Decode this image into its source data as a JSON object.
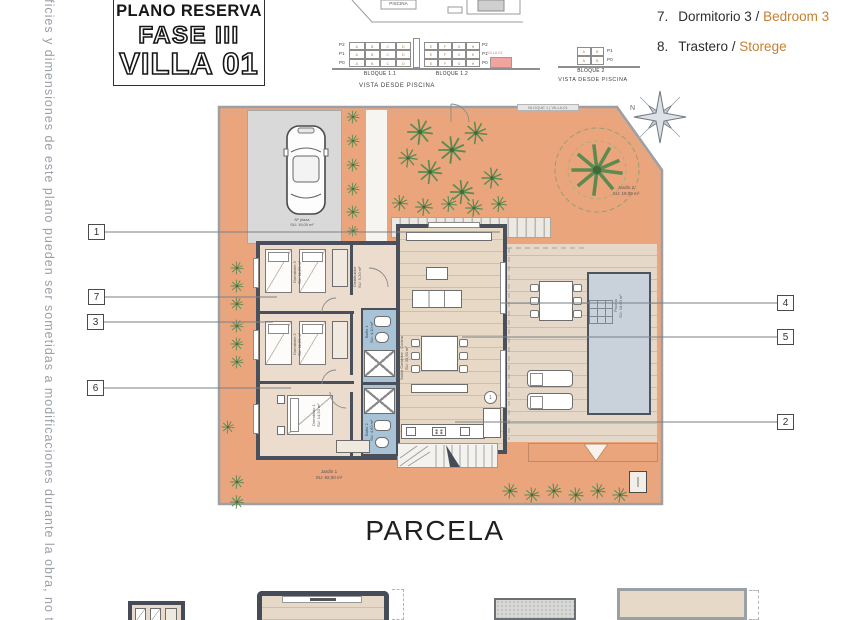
{
  "side_note": "erficies y dimensiones de este plano pueden ser sometidas a modificaciones durante la obra, no teniendo",
  "title_block": {
    "line1": "PLANO RESERVA",
    "line2": "FASE III",
    "line3": "VILLA 01"
  },
  "site_sketch": {
    "piscina": "PISCINA"
  },
  "elevations": {
    "floors_left": [
      "P2",
      "P1",
      "P0"
    ],
    "floors_right": [
      "P2",
      "P1",
      "P0"
    ],
    "bloque11": {
      "label": "BLOQUE 1.1",
      "cells": [
        "A",
        "B",
        "C",
        "D"
      ]
    },
    "bloque12": {
      "label": "BLOQUE 1.2",
      "cells": [
        "E",
        "F",
        "G",
        "H"
      ]
    },
    "villa_tag": "VILLA 01",
    "caption_left": "VISTA DESDE PISCINA",
    "bloque2": {
      "label": "BLOQUE 2",
      "cells": [
        "A",
        "B"
      ],
      "floors": [
        "P1",
        "P0"
      ]
    },
    "caption_right": "VISTA DESDE PISCINA"
  },
  "legend": {
    "items": [
      {
        "num": "7.",
        "name": "Dormitorio 3 /",
        "alt": "Bedroom 3"
      },
      {
        "num": "8.",
        "name": "Trastero /",
        "alt": "Storege"
      }
    ]
  },
  "plan": {
    "block_tag": "BLOQUE 1 | VILLA 01",
    "north": "N",
    "parking": "Nº plaza\nSU: 19,00 m²",
    "garden2": "Jardín 2\nSU: 19,00 m²",
    "garden1": "Jardín 1\nSU: 92,00 m²",
    "rooms": {
      "bedroom3": "Dormitorio 3\nSU: 11,20 m²",
      "bedroom2": "Dormitorio 2\nSU: 11,20 m²",
      "bedroom1": "Dormitorio 1\nSU: 14,50 m²",
      "bath1": "Baño 1\nSU: 4,10 m²",
      "bath2": "Baño 2\nSU: 4,60 m²",
      "hall": "Distribuidor\nSU: 5,20 m²",
      "salon": "Salón Comedor - Cocina\nSU: 33,90 m²",
      "pool": "Piscina\nSU: 18,60 m²"
    },
    "callouts": {
      "c1": "1",
      "c7": "7",
      "c3": "3",
      "c6": "6",
      "c4": "4",
      "c5": "5",
      "c2": "2"
    }
  },
  "parcela_label": "PARCELA",
  "colors": {
    "terracotta": "#eaa57d",
    "wall": "#49505b",
    "bath_blue": "#a9c3d6",
    "floor_beige": "#e7d9c6",
    "pool": "#c9d2da",
    "accent_orange": "#c5802f"
  }
}
